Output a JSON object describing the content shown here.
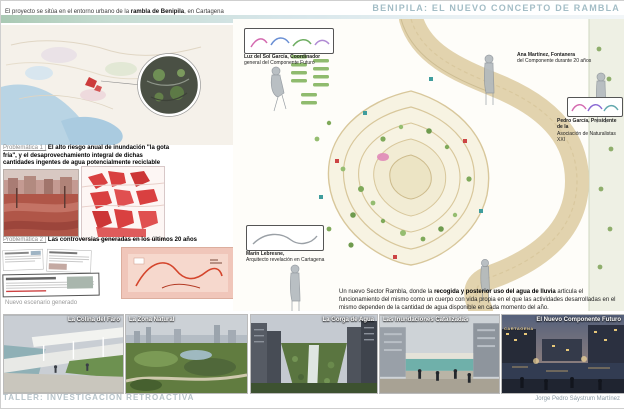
{
  "header": {
    "title": "BENIPILA: EL NUEVO CONCEPTO DE RAMBLA",
    "intro_prefix": "El proyecto se sitúa en el entorno urbano de la ",
    "intro_bold": "rambla de Benipila",
    "intro_suffix": ", en Cartagena"
  },
  "problematica1": {
    "label": "Problemática 1 |",
    "text": "El alto riesgo anual de inundación \"la gota fría\", y el desaprovechamiento integral de dichas cantidades ingentes de agua potencialmente reciclable"
  },
  "problematica2": {
    "label": "Problemática 2 |",
    "text": "Las controversias generadas en los últimos 20 años"
  },
  "nuevo_escenario_label": "Nuevo escenario generado",
  "description": {
    "prefix": "Un nuevo Sector Rambla, donde la ",
    "bold": "recogida y posterior uso del agua de lluvia",
    "suffix": " articula el funcionamiento del mismo como un cuerpo con vida propia en el que las actividades desarrolladas en el mismo dependen de la cantidad de agua disponible en cada momento del año."
  },
  "people": [
    {
      "name": "Luz del Sol García, Coordinador",
      "role": "general del Componente Futuro"
    },
    {
      "name": "Ana Martínez, Fontanera",
      "role": "del Componente durante 20 años"
    },
    {
      "name": "Pedro García, Presidente de la",
      "role": "Asociación de Naturalistas XXI"
    },
    {
      "name": "Marín Lebresne,",
      "role": "Arquitecto revelación en Cartagena"
    }
  ],
  "cards": [
    {
      "label": "La Colina del Faro"
    },
    {
      "label": "La Zona Natural"
    },
    {
      "label": "La Gorga de Agua"
    },
    {
      "label": "Las Inundaciones Catalizadas"
    },
    {
      "label": "El Nuevo Componente Futuro",
      "subtext": "CARTAGENA"
    }
  ],
  "footer": {
    "left": "TALLER: INVESTIGACIÓN RETROACTIVA",
    "right": "Jorge Pedro Sáystrum Martínez"
  },
  "colors": {
    "title_accent": "#a3bdc6",
    "band_teal": "#c6dcd2",
    "river_tan": "#e2d3ae",
    "park_contour": "#d8c79b",
    "tree_green": "#7fa95a",
    "flood_red": "#b05648",
    "figure_ground_red": "#d94040"
  }
}
